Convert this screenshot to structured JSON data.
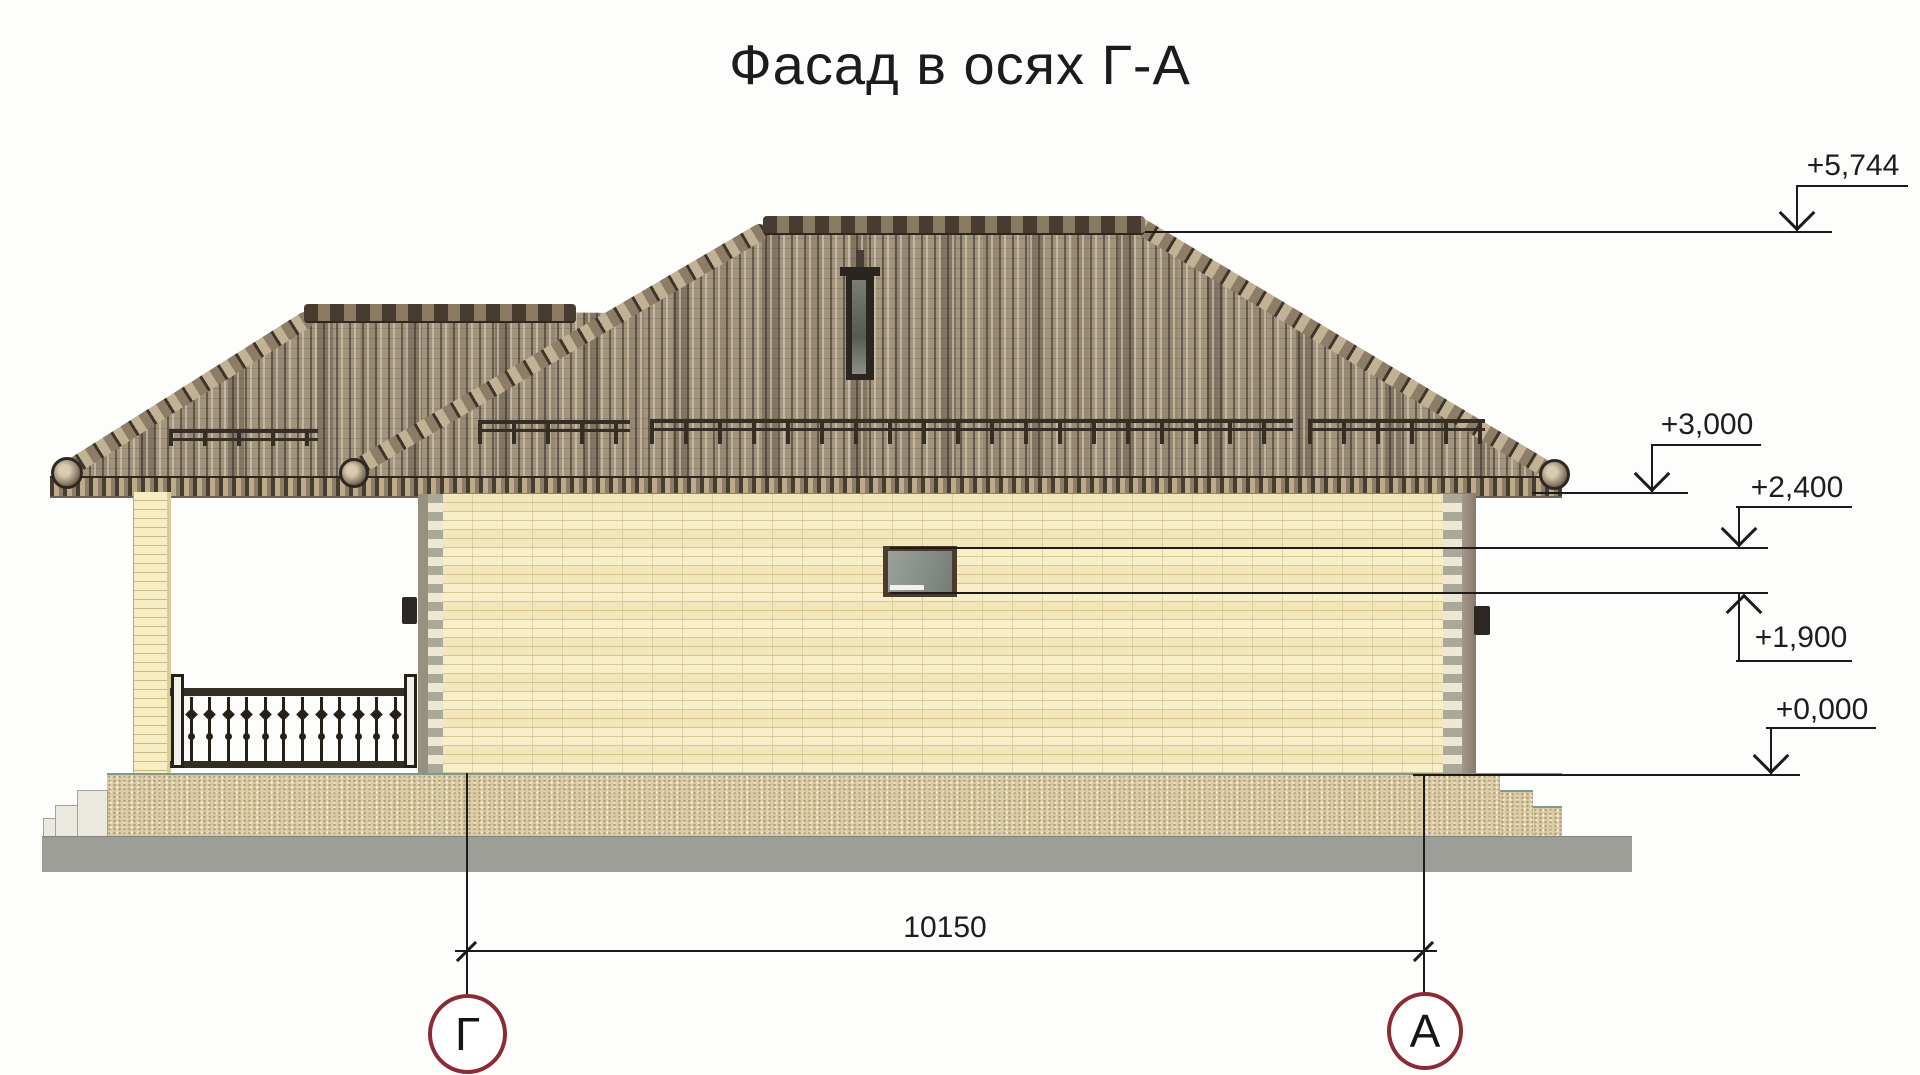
{
  "title": "Фасад в осях Г-А",
  "marks": {
    "ridge": "+5,744",
    "eaves": "+3,000",
    "window_top": "+2,400",
    "window_sill": "+1,900",
    "ground": "+0,000"
  },
  "dimension": {
    "axis_span": "10150"
  },
  "axes": {
    "left": "Г",
    "right": "А"
  },
  "colors": {
    "axis_circle": "#8b2b35",
    "wall_brick": "#f8efc8",
    "roof": "#a2947d",
    "sand": "#dccda6",
    "slab": "#9e9e99"
  }
}
